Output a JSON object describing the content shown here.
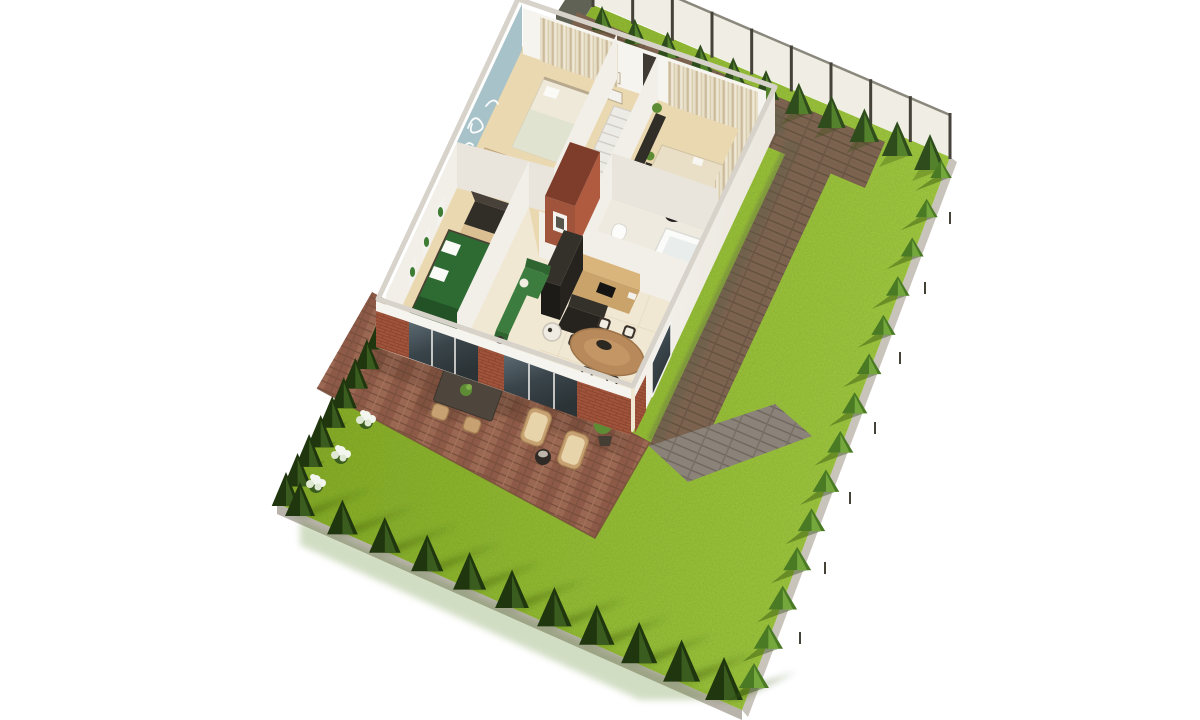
{
  "palette": {
    "bg": "#ffffff",
    "lawn1": "#8ab125",
    "lawn2": "#9cc53a",
    "lawn3": "#a6cf45",
    "lawnShadow": "#2e4c0c",
    "edgeDark": "#333a24",
    "slab": "#b8b3ab",
    "slab2": "#c8c3bb",
    "fenceFace": "#f0ede4",
    "fencePost": "#45423a",
    "fenceRail": "#8a877c",
    "fenceDarkPanel": "#5f6254",
    "lowWall": "#d6d3cc",
    "boundaryLine": "#8e8b82",
    "pathBrown": "#7b634f",
    "pathBrownLine": "#63503f",
    "pathGray": "#8b8379",
    "pathGrayLine": "#6f675d",
    "patioBrick": "#9a6852",
    "patioBrickAlt": "#8c5a46",
    "patioLine": "#774d3c",
    "treeDark": "#20360e",
    "treeDarkLit": "#3a5c1e",
    "treeMid": "#2f4d1c",
    "treeMidLit": "#54822c",
    "bushGreen": "#4a7a24",
    "bushGreenLit": "#74a83c",
    "flowerWhite": "#f3f6ee",
    "flowerShade": "#dfe8d2",
    "houseShadow": "#5e6148",
    "wallWhite": "#f6f4ef",
    "wallShade": "#eae6de",
    "wallInner": "#f2efe8",
    "wallInner2": "#e9e5dc",
    "wallCap": "#d7d3cb",
    "brick": "#a1543c",
    "brickDark": "#7e3d2a",
    "brickLight": "#b05a40",
    "glassTop": "#55626a",
    "glassBot": "#2d3538",
    "frameWhite": "#f4f2ee",
    "floorWood": "#ead8b0",
    "floorTile": "#f1e8d4",
    "floorBath": "#efeae0",
    "tileLine": "#ddcfae",
    "teal": "#a7c2c8",
    "script": "#ffffff",
    "curtainA": "#e8dfc8",
    "curtainB": "#cbbb9a",
    "curtainC": "#efe8d6",
    "bedCream": "#efe9da",
    "bedSage": "#e0e3cf",
    "pillowWhite": "#fafaf7",
    "headboard": "#b7a98e",
    "bedGreen": "#2e6b33",
    "bedGreenDark": "#235226",
    "throwWhite": "#f4f4f0",
    "bedFrame": "#4a3f33",
    "darkFurn": "#312d27",
    "darkFurnTop": "#47413a",
    "woodFurn": "#c59e66",
    "woodDesk": "#d9bf92",
    "deskWhite": "#e9dfc6",
    "sofaGreen": "#3c7c3e",
    "sofaGreenDark": "#2f6531",
    "stair": "#edebe6",
    "stairLine": "#d2cec6",
    "tub": "#fbfbf9",
    "tubInner": "#e9edec",
    "fixtureWhite": "#fcfcfa",
    "kitchenDark": "#26231e",
    "kitchenDarkFace": "#1d1b17",
    "kitchenDarkTop": "#34312a",
    "counterWood": "#caa36a",
    "counterTopWood": "#d9b57c",
    "cooktop": "#151413",
    "tableWood": "#b8895a",
    "tableWoodDark": "#9e744a",
    "chairDark": "#3b332b",
    "cushion": "#f1ede3",
    "pendantDark": "#2b2822",
    "outTable": "#4e463c",
    "wicker": "#c7a171",
    "wickerDark": "#a37f52",
    "cushionOut": "#e8d4ab",
    "potDark": "#443d33",
    "plantGreen": "#5d8c35",
    "plantGreenLight": "#7fae4a",
    "plantGreenDark": "#3f6423",
    "artGreen": "#3e7d33"
  },
  "scene": {
    "kind": "3d-cutaway-floor-plan-render",
    "plot_corners": {
      "top": [
        593,
        5
      ],
      "right": [
        950,
        157
      ],
      "bottom": [
        742,
        710
      ],
      "left": [
        277,
        503
      ]
    },
    "rooms": [
      {
        "label": "nursery-bedroom"
      },
      {
        "label": "hallway-stairs"
      },
      {
        "label": "home-office"
      },
      {
        "label": "bathroom"
      },
      {
        "label": "green-bedroom"
      },
      {
        "label": "kitchen"
      },
      {
        "label": "dining-area"
      },
      {
        "label": "living-nook"
      }
    ],
    "garden": {
      "fence": {
        "from": [
          593,
          5
        ],
        "to": [
          950,
          157
        ],
        "height": 42,
        "posts": 9
      },
      "treeBelts": [
        {
          "name": "fence-tree-row",
          "from": [
            602,
            30
          ],
          "to": [
            930,
            170
          ],
          "count": 11,
          "h0": 24,
          "h1": 36,
          "w": 0.44,
          "body": "treeMid",
          "lit": "treeMidLit",
          "shadow": {
            "dx": -18,
            "dy": 11,
            "op": 0.28
          }
        },
        {
          "name": "upper-left-hedge",
          "from": [
            390,
            330
          ],
          "to": [
            286,
            506
          ],
          "count": 10,
          "h0": 29,
          "h1": 34,
          "w": 0.42,
          "body": "treeDark",
          "lit": "treeDarkLit",
          "shadow": {
            "dx": 16,
            "dy": -6,
            "op": 0.22
          }
        },
        {
          "name": "bottom-left-tree-row",
          "from": [
            300,
            516
          ],
          "to": [
            724,
            700
          ],
          "count": 11,
          "h0": 34,
          "h1": 43,
          "w": 0.44,
          "body": "treeDark",
          "lit": "treeDarkLit",
          "shadow": {
            "dx": 72,
            "dy": -28,
            "op": 0.4,
            "blur": true
          }
        },
        {
          "name": "right-bush-row",
          "from": [
            941,
            178
          ],
          "to": [
            754,
            688
          ],
          "count": 14,
          "h0": 18,
          "h1": 25,
          "w": 0.6,
          "body": "bushGreen",
          "lit": "bushGreenLit",
          "shadow": {
            "dx": -26,
            "dy": 13,
            "op": 0.42
          }
        }
      ],
      "flowerBushes": [
        [
          366,
          420
        ],
        [
          341,
          455
        ],
        [
          316,
          484
        ]
      ],
      "rightEdgeTicks": [
        [
          950,
          222
        ],
        [
          925,
          292
        ],
        [
          900,
          362
        ],
        [
          875,
          432
        ],
        [
          850,
          502
        ],
        [
          825,
          572
        ],
        [
          800,
          642
        ]
      ]
    },
    "house": {
      "stairs": {
        "a": [
          614,
          106
        ],
        "b": [
          647,
          117
        ],
        "c": [
          611,
          195
        ],
        "d": [
          578,
          184
        ],
        "steps": 9
      }
    }
  }
}
